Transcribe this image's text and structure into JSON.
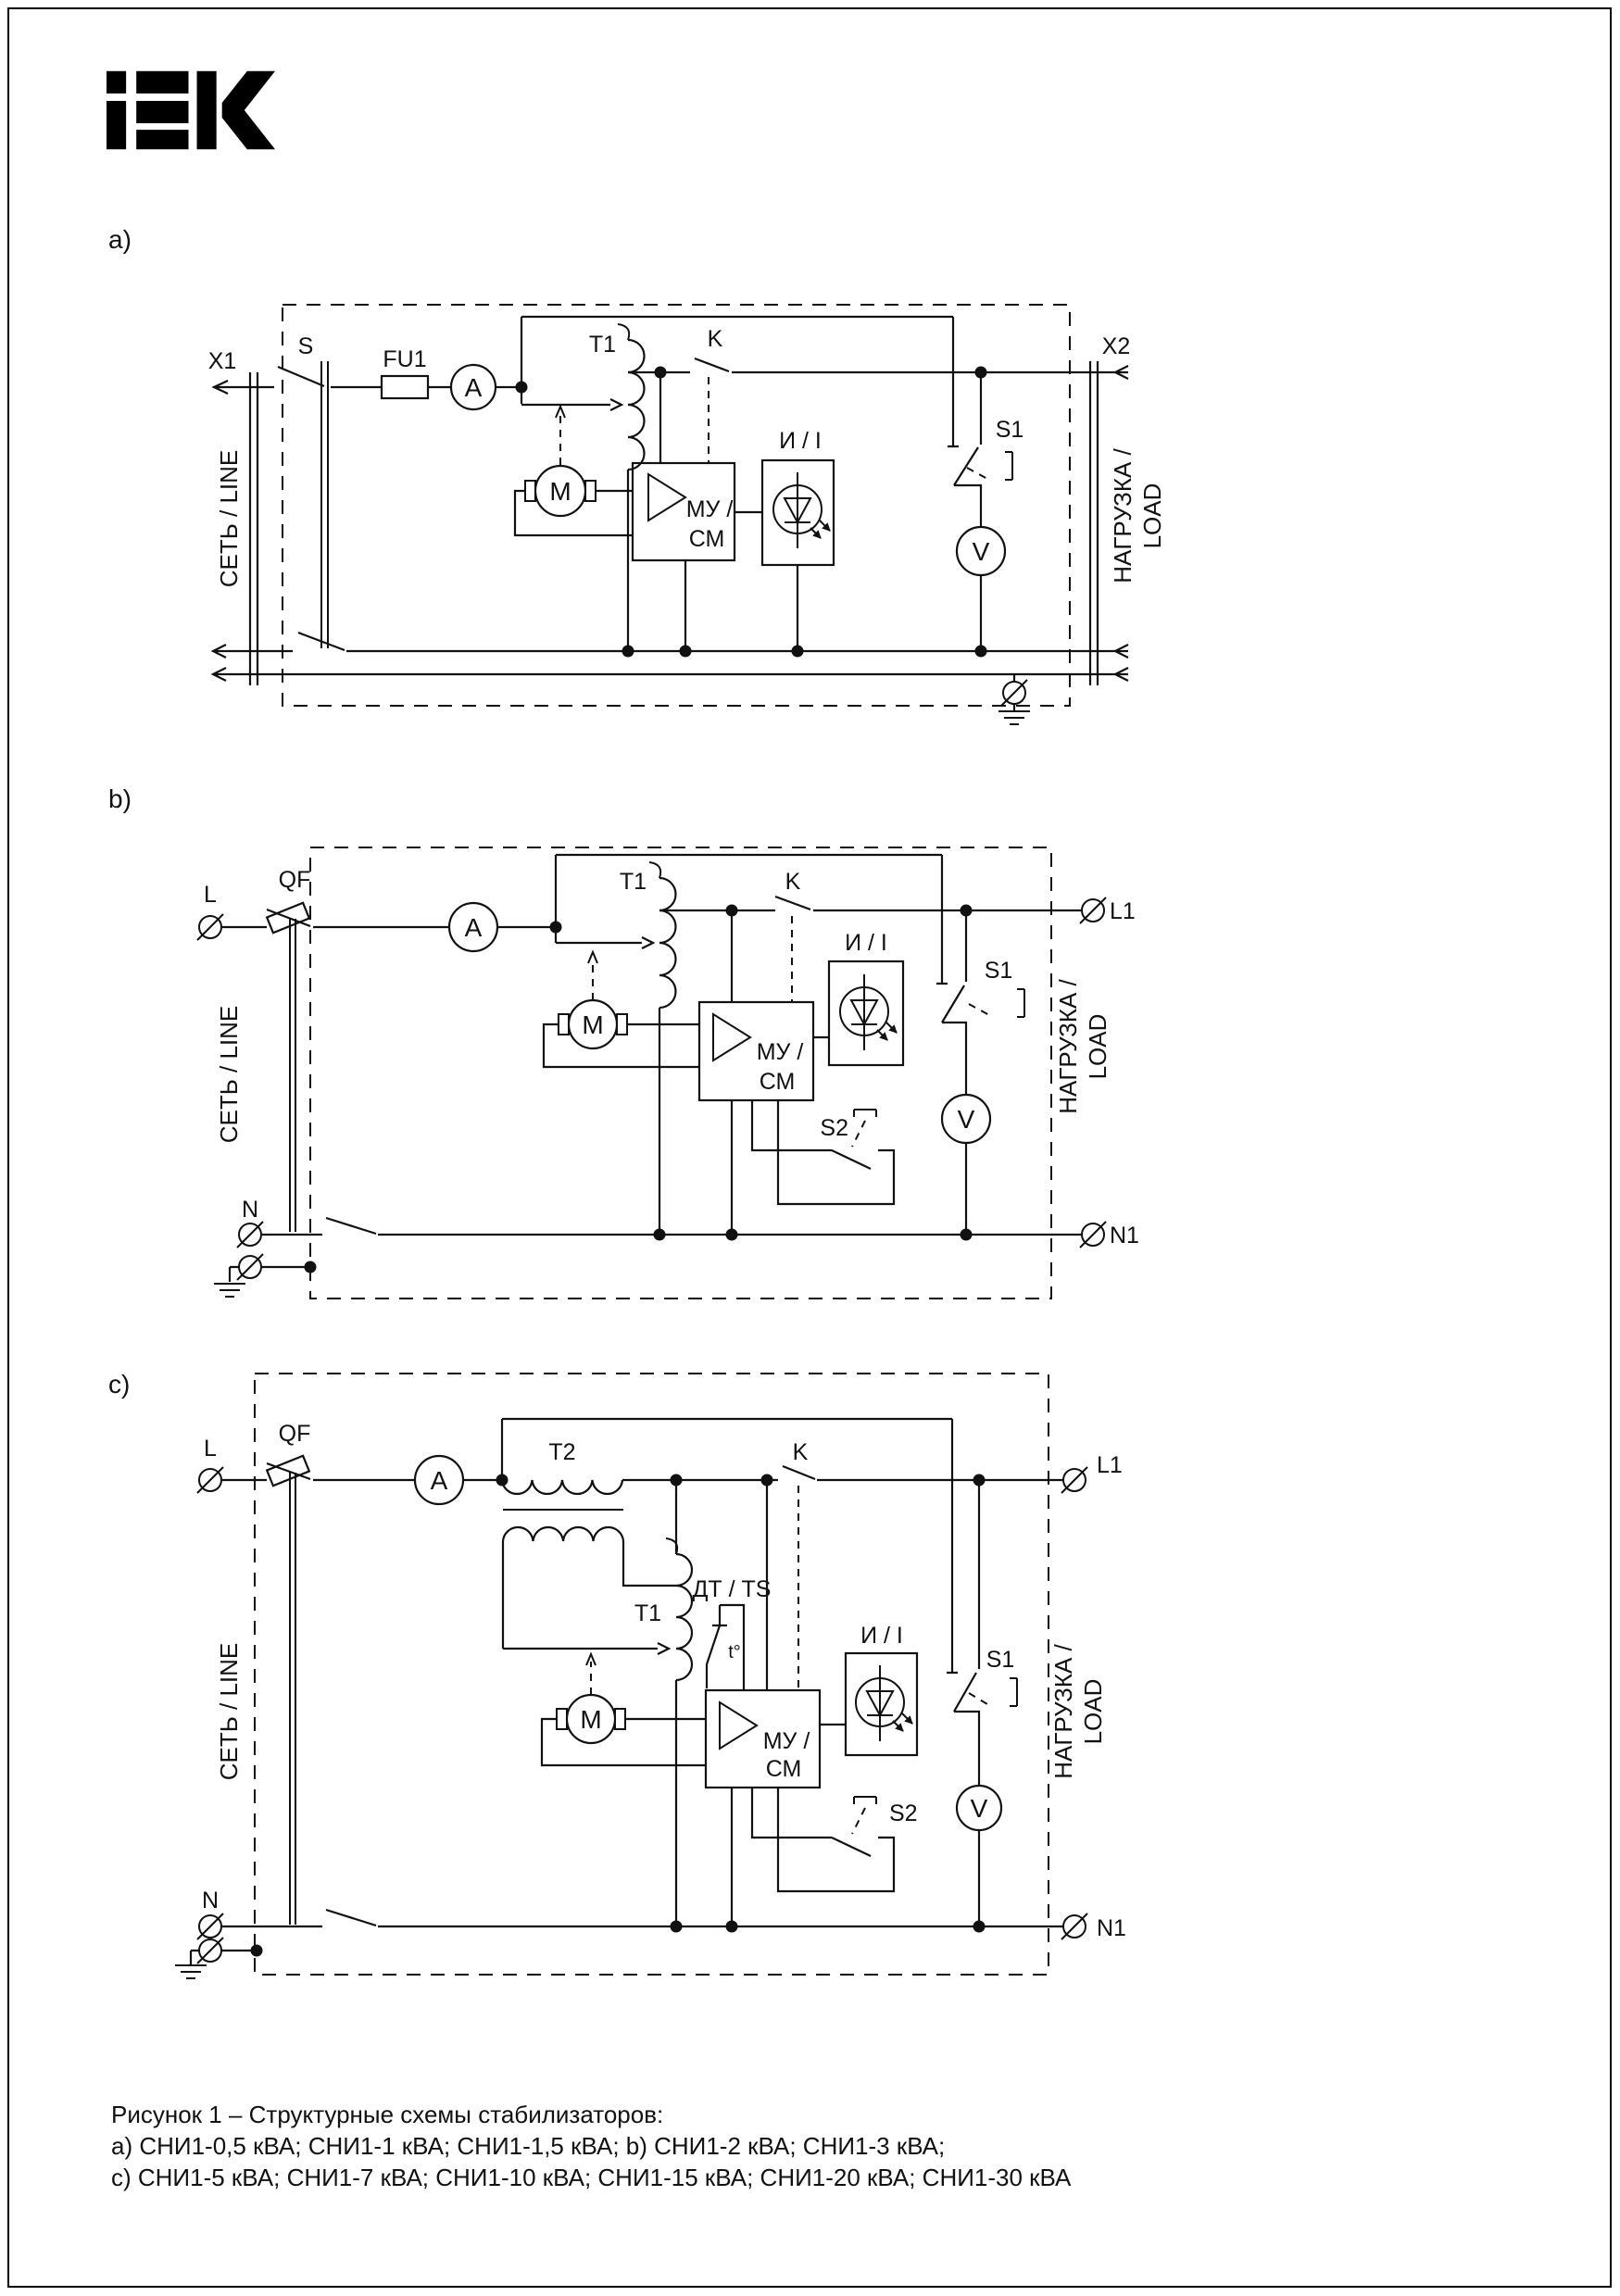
{
  "page": {
    "background": "#ffffff",
    "ink": "#000000"
  },
  "logo": {
    "brand": "IEK"
  },
  "diagram_a": {
    "section_label": "a)",
    "terminal_x1": "X1",
    "switch_s": "S",
    "fuse": "FU1",
    "ammeter": "A",
    "transformer_t1": "T1",
    "contactor_k": "K",
    "terminal_x2": "X2",
    "motor": "M",
    "control_block_line1": "МУ /",
    "control_block_line2": "СМ",
    "indicator_label": "И / I",
    "switch_s1": "S1",
    "voltmeter": "V",
    "line_side_label": "СЕТЬ / LINE",
    "load_side_label_line1": "НАГРУЗКА /",
    "load_side_label_line2": "LOAD"
  },
  "diagram_b": {
    "section_label": "b)",
    "terminal_l": "L",
    "breaker_qf": "QF",
    "ammeter": "A",
    "transformer_t1": "T1",
    "contactor_k": "K",
    "motor": "M",
    "control_block_line1": "МУ /",
    "control_block_line2": "СМ",
    "indicator_label": "И / I",
    "switch_s1": "S1",
    "switch_s2": "S2",
    "voltmeter": "V",
    "terminal_l1": "L1",
    "terminal_n": "N",
    "terminal_n1": "N1",
    "line_side_label": "СЕТЬ / LINE",
    "load_side_label_line1": "НАГРУЗКА /",
    "load_side_label_line2": "LOAD"
  },
  "diagram_c": {
    "section_label": "c)",
    "terminal_l": "L",
    "breaker_qf": "QF",
    "ammeter": "A",
    "transformer_t2": "T2",
    "transformer_t1": "T1",
    "contactor_k": "K",
    "thermal_sensor_label": "ДТ / TS",
    "thermal_contact": "t°",
    "motor": "M",
    "control_block_line1": "МУ /",
    "control_block_line2": "СМ",
    "indicator_label": "И / I",
    "switch_s1": "S1",
    "switch_s2": "S2",
    "voltmeter": "V",
    "terminal_l1": "L1",
    "terminal_n": "N",
    "terminal_n1": "N1",
    "line_side_label": "СЕТЬ / LINE",
    "load_side_label_line1": "НАГРУЗКА /",
    "load_side_label_line2": "LOAD"
  },
  "caption": {
    "line1": "Рисунок 1 – Структурные схемы стабилизаторов:",
    "line2": "a) СНИ1-0,5 кВА; СНИ1-1 кВА; СНИ1-1,5 кВА;   b) СНИ1-2 кВА; СНИ1-3 кВА;",
    "line3": "c) СНИ1-5 кВА; СНИ1-7 кВА; СНИ1-10 кВА; СНИ1-15 кВА; СНИ1-20 кВА; СНИ1-30 кВА"
  }
}
